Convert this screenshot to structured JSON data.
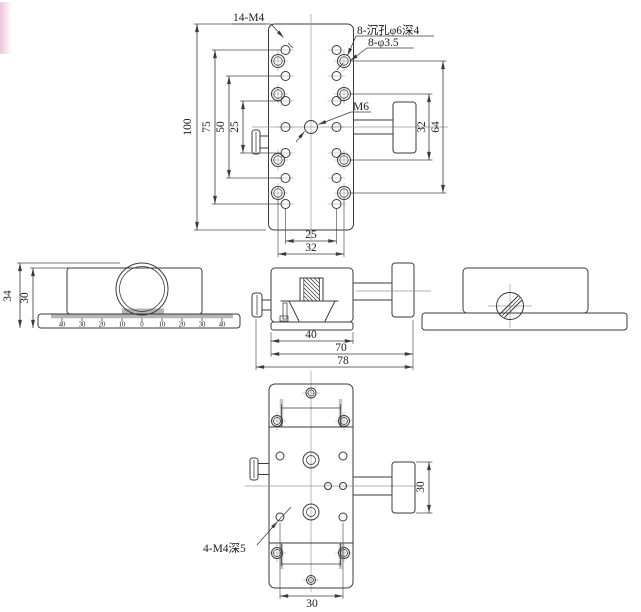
{
  "colors": {
    "line": "#3a3a3a",
    "centerline": "#9a9a9a",
    "rail_highlight": "#c6c6c6",
    "pink_artifact": "#eec3dd"
  },
  "top_view": {
    "label_14_m4": "14-M4",
    "label_counterbore": "8-沉孔φ6深4",
    "label_through_hole": "8-φ3.5",
    "label_m6": "M6",
    "dim_height": "100",
    "dim_75": "75",
    "dim_50": "50",
    "dim_25_vertical": "25",
    "dim_hole_span_25": "25",
    "dim_hole_span_32": "32",
    "dim_right_32": "32",
    "dim_right_64": "64"
  },
  "side_view": {
    "dim_total_height": "34",
    "dim_body_height": "30",
    "scale_labels": [
      "40",
      "30",
      "20",
      "10",
      "0",
      "10",
      "20",
      "30",
      "40"
    ]
  },
  "front_view": {
    "dim_platform": "40",
    "dim_70": "70",
    "dim_78": "78"
  },
  "bottom_view": {
    "label_4_m4": "4-M4深5",
    "dim_knob_30": "30",
    "dim_holes_30": "30"
  }
}
